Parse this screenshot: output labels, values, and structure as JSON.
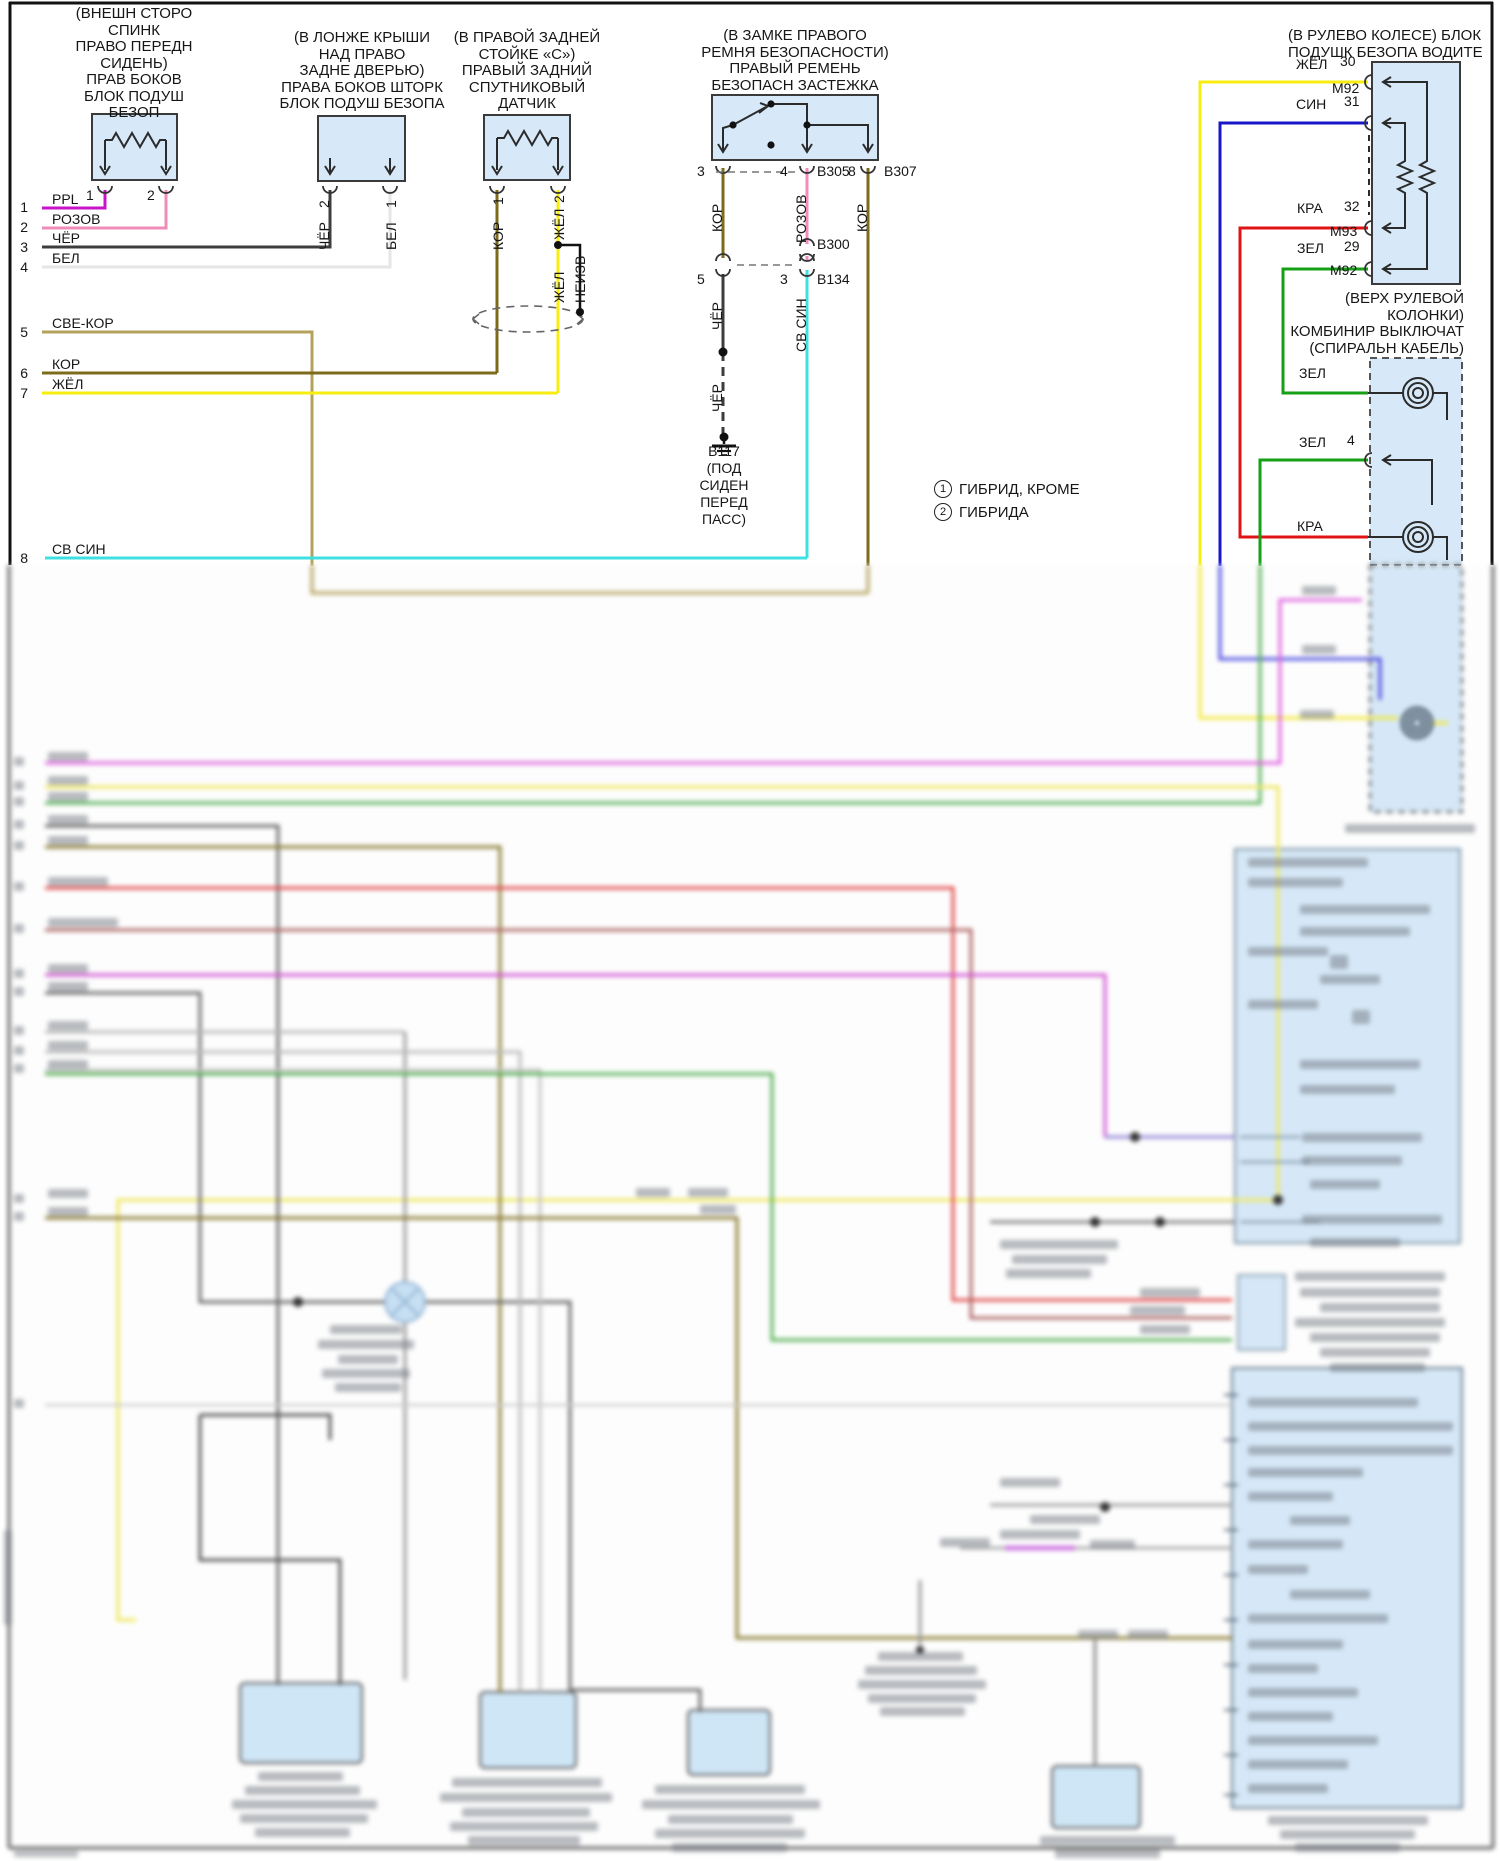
{
  "boxes": {
    "side_airbag_title": [
      "(ВНЕШН СТОРО",
      "СПИНК",
      "ПРАВО ПЕРЕДН",
      "СИДЕНЬ)",
      "ПРАВ БОКОВ",
      "БЛОК ПОДУШ",
      "БЕЗОП"
    ],
    "curtain_airbag_title": [
      "(В ЛОНЖЕ КРЫШИ",
      "НАД ПРАВО",
      "ЗАДНЕ ДВЕРЬЮ)",
      "ПРАВА БОКОВ ШТОРК",
      "БЛОК ПОДУШ БЕЗОПА"
    ],
    "satellite_sensor_title": [
      "(В ПРАВОЙ ЗАДНЕЙ",
      "СТОЙКЕ «С»)",
      "ПРАВЫЙ ЗАДНИЙ",
      "СПУТНИКОВЫЙ",
      "ДАТЧИК"
    ],
    "buckle_title": [
      "(В ЗАМКЕ ПРАВОГО",
      "РЕМНЯ БЕЗОПАСНОСТИ)",
      "ПРАВЫЙ РЕМЕНЬ",
      "БЕЗОПАСН ЗАСТЕЖКА"
    ],
    "driver_airbag_title": [
      "(В РУЛЕВО КОЛЕСЕ) БЛОК",
      "ПОДУШК БЕЗОПА ВОДИТЕ"
    ],
    "clockspring_title": [
      "(ВЕРХ РУЛЕВОЙ",
      "КОЛОНКИ)",
      "КОМБИНИР ВЫКЛЮЧАТ",
      "(СПИРАЛЬН КАБЕЛЬ)"
    ]
  },
  "left_wires": [
    {
      "num": "1",
      "label": "PPL"
    },
    {
      "num": "2",
      "label": "РОЗОВ"
    },
    {
      "num": "3",
      "label": "ЧЁР"
    },
    {
      "num": "4",
      "label": "БЕЛ"
    },
    {
      "num": "5",
      "label": "СВЕ-КОР"
    },
    {
      "num": "6",
      "label": "КОР"
    },
    {
      "num": "7",
      "label": "ЖЁЛ"
    },
    {
      "num": "8",
      "label": "СВ СИН"
    }
  ],
  "pins": {
    "comp1_p1": "1",
    "comp1_p2": "2",
    "comp2_p2": "2",
    "comp2_p1": "1",
    "comp2_w2": "ЧЁР",
    "comp2_w1": "БЕЛ",
    "comp3_p1": "1",
    "comp3_p2": "2",
    "comp3_w1": "КОР",
    "comp3_w2": "ЖЁЛ",
    "comp3_w2b": "ЖЁЛ",
    "unknown": "НЕИЗВ",
    "buckle_p3": "3",
    "buckle_p4": "4",
    "buckle_p8": "8",
    "buckle_w3": "КОР",
    "buckle_w4": "РОЗОВ",
    "buckle_w8": "КОР",
    "conn_p5": "5",
    "conn_p3": "3",
    "w5": "ЧЁР",
    "w5b": "ЧЁР",
    "w_b134": "СВ СИН",
    "p30": "30",
    "p31": "31",
    "p32": "32",
    "p29": "29",
    "p4": "4",
    "m92a": "M92",
    "m93": "M93",
    "m92b": "M92",
    "w30": "ЖЁЛ",
    "w31": "СИН",
    "w32": "КРА",
    "w29": "ЗЕЛ",
    "w29b": "ЗЕЛ",
    "w4": "ЗЕЛ",
    "w32b": "КРА"
  },
  "connectors": {
    "b305": "B305",
    "b307": "B307",
    "b300": "B300",
    "b134": "B134"
  },
  "ground_label": [
    "B117",
    "(ПОД",
    "СИДЕН",
    "ПЕРЕД",
    "ПАСС)"
  ],
  "legend": [
    {
      "num": "1",
      "text": "ГИБРИД, КРОМЕ"
    },
    {
      "num": "2",
      "text": "ГИБРИДА"
    }
  ],
  "colors": {
    "ppl": "#c813c8",
    "pink": "#f08cb8",
    "black_wire": "#3d3d3d",
    "white_wire": "#e6e6e6",
    "lt_brown": "#b3a15c",
    "brown": "#7d6b1c",
    "yellow": "#f7ee10",
    "lt_blue": "#3fe0e0",
    "blue": "#1717c9",
    "red": "#e01414",
    "green": "#16a016",
    "box_fill": "#d7e9f8",
    "box_border": "#3a3a3a",
    "line": "#2b2b2b"
  }
}
